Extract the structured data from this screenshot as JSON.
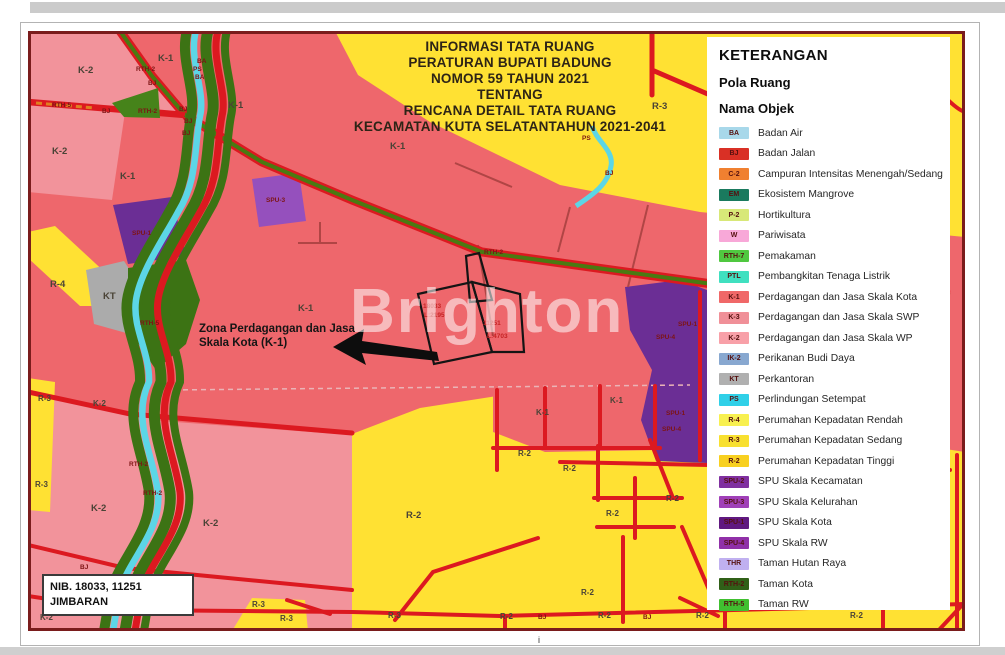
{
  "watermark": "Brighton",
  "title": {
    "lines": [
      "INFORMASI TATA RUANG",
      "PERATURAN BUPATI BADUNG",
      "NOMOR 59 TAHUN 2021",
      "TENTANG",
      "RENCANA DETAIL TATA RUANG",
      "KECAMATAN KUTA SELATANTAHUN 2021-2041"
    ]
  },
  "annotation": {
    "line1": "Zona Perdagangan dan Jasa",
    "line2": "Skala Kota (K-1)"
  },
  "nib_box": {
    "line1": "NIB. 18033, 11251",
    "line2": "JIMBARAN"
  },
  "tick": "i",
  "legend": {
    "title": "KETERANGAN",
    "subtitle1": "Pola Ruang",
    "subtitle2": "Nama Objek",
    "items": [
      {
        "code": "BA",
        "color": "#a8d8ea",
        "label": "Badan Air"
      },
      {
        "code": "BJ",
        "color": "#d93025",
        "label": "Badan Jalan"
      },
      {
        "code": "C-2",
        "color": "#f08030",
        "label": "Campuran Intensitas Menengah/Sedang"
      },
      {
        "code": "EM",
        "color": "#1a7a5e",
        "label": "Ekosistem Mangrove"
      },
      {
        "code": "P-2",
        "color": "#d8e878",
        "label": "Hortikultura"
      },
      {
        "code": "W",
        "color": "#f8a8d8",
        "label": "Pariwisata"
      },
      {
        "code": "RTH-7",
        "color": "#50c840",
        "label": "Pemakaman"
      },
      {
        "code": "PTL",
        "color": "#40e0c0",
        "label": "Pembangkitan Tenaga Listrik"
      },
      {
        "code": "K-1",
        "color": "#f06868",
        "label": "Perdagangan dan Jasa Skala Kota"
      },
      {
        "code": "K-3",
        "color": "#f09098",
        "label": "Perdagangan dan Jasa Skala SWP"
      },
      {
        "code": "K-2",
        "color": "#f8a0a8",
        "label": "Perdagangan dan Jasa Skala WP"
      },
      {
        "code": "IK-2",
        "color": "#88a8d0",
        "label": "Perikanan Budi Daya"
      },
      {
        "code": "KT",
        "color": "#b0b0b0",
        "label": "Perkantoran"
      },
      {
        "code": "PS",
        "color": "#30d0e8",
        "label": "Perlindungan Setempat"
      },
      {
        "code": "R-4",
        "color": "#f8f050",
        "label": "Perumahan Kepadatan Rendah"
      },
      {
        "code": "R-3",
        "color": "#f8e030",
        "label": "Perumahan Kepadatan Sedang"
      },
      {
        "code": "R-2",
        "color": "#f8d020",
        "label": "Perumahan Kepadatan Tinggi"
      },
      {
        "code": "SPU-2",
        "color": "#8030a0",
        "label": "SPU Skala Kecamatan"
      },
      {
        "code": "SPU-3",
        "color": "#a040b8",
        "label": "SPU Skala Kelurahan"
      },
      {
        "code": "SPU-1",
        "color": "#601880",
        "label": "SPU Skala Kota"
      },
      {
        "code": "SPU-4",
        "color": "#9030a8",
        "label": "SPU Skala RW"
      },
      {
        "code": "THR",
        "color": "#c0b0f0",
        "label": "Taman Hutan Raya"
      },
      {
        "code": "RTH-2",
        "color": "#306018",
        "label": "Taman Kota"
      },
      {
        "code": "RTH-5",
        "color": "#40c030",
        "label": "Taman RW"
      }
    ]
  },
  "colors": {
    "k1_commercial": "#ee676c",
    "k2_commercial": "#f2939b",
    "residential_yellow": "#ffe133",
    "road_red": "#dc1920",
    "river_cyan": "#5cd6e6",
    "green_rth": "#3c7314",
    "purple_spu": "#6b2e95",
    "gray_kt": "#ababab"
  },
  "map": {
    "labels": [
      {
        "t": "K-2",
        "x": 78,
        "y": 73,
        "k": "z"
      },
      {
        "t": "K-1",
        "x": 158,
        "y": 61,
        "k": "z"
      },
      {
        "t": "K-1",
        "x": 228,
        "y": 108,
        "k": "z"
      },
      {
        "t": "K-1",
        "x": 390,
        "y": 149,
        "k": "z"
      },
      {
        "t": "R-3",
        "x": 652,
        "y": 109,
        "k": "z"
      },
      {
        "t": "K-2",
        "x": 52,
        "y": 154,
        "k": "z"
      },
      {
        "t": "K-1",
        "x": 120,
        "y": 179,
        "k": "z"
      },
      {
        "t": "K-1",
        "x": 298,
        "y": 311,
        "k": "z"
      },
      {
        "t": "R-4",
        "x": 50,
        "y": 287,
        "k": "z"
      },
      {
        "t": "KT",
        "x": 103,
        "y": 299,
        "k": "z"
      },
      {
        "t": "K-1",
        "x": 536,
        "y": 415,
        "k": "zs"
      },
      {
        "t": "K-1",
        "x": 610,
        "y": 403,
        "k": "zs"
      },
      {
        "t": "K-2",
        "x": 93,
        "y": 406,
        "k": "zs"
      },
      {
        "t": "K-2",
        "x": 91,
        "y": 511,
        "k": "z"
      },
      {
        "t": "K-2",
        "x": 203,
        "y": 526,
        "k": "z"
      },
      {
        "t": "R-3",
        "x": 38,
        "y": 401,
        "k": "zs"
      },
      {
        "t": "R-3",
        "x": 35,
        "y": 487,
        "k": "zs"
      },
      {
        "t": "R-2",
        "x": 406,
        "y": 518,
        "k": "z"
      },
      {
        "t": "R-2",
        "x": 518,
        "y": 456,
        "k": "zs"
      },
      {
        "t": "R-2",
        "x": 563,
        "y": 471,
        "k": "zs"
      },
      {
        "t": "R-2",
        "x": 606,
        "y": 516,
        "k": "zs"
      },
      {
        "t": "R-2",
        "x": 666,
        "y": 501,
        "k": "zs"
      },
      {
        "t": "R-2",
        "x": 581,
        "y": 595,
        "k": "zs"
      },
      {
        "t": "K-2",
        "x": 40,
        "y": 620,
        "k": "zs"
      },
      {
        "t": "K-2",
        "x": 170,
        "y": 615,
        "k": "zs"
      },
      {
        "t": "R-3",
        "x": 252,
        "y": 607,
        "k": "zs"
      },
      {
        "t": "R-3",
        "x": 280,
        "y": 621,
        "k": "zs"
      },
      {
        "t": "R-3",
        "x": 388,
        "y": 618,
        "k": "zs"
      },
      {
        "t": "R-2",
        "x": 500,
        "y": 619,
        "k": "zs"
      },
      {
        "t": "R-2",
        "x": 598,
        "y": 618,
        "k": "zs"
      },
      {
        "t": "R-2",
        "x": 696,
        "y": 618,
        "k": "zs"
      },
      {
        "t": "R-2",
        "x": 850,
        "y": 618,
        "k": "zs"
      },
      {
        "t": "BA",
        "x": 197,
        "y": 63,
        "k": "r"
      },
      {
        "t": "PS",
        "x": 193,
        "y": 71,
        "k": "r"
      },
      {
        "t": "BA",
        "x": 195,
        "y": 79,
        "k": "r"
      },
      {
        "t": "RTH-2",
        "x": 136,
        "y": 71,
        "k": "r"
      },
      {
        "t": "BJ",
        "x": 148,
        "y": 85,
        "k": "r"
      },
      {
        "t": "RTH-5",
        "x": 52,
        "y": 107,
        "k": "r"
      },
      {
        "t": "BJ",
        "x": 102,
        "y": 113,
        "k": "r"
      },
      {
        "t": "RTH-2",
        "x": 138,
        "y": 113,
        "k": "r"
      },
      {
        "t": "BJ",
        "x": 179,
        "y": 111,
        "k": "r"
      },
      {
        "t": "BJ",
        "x": 184,
        "y": 123,
        "k": "r"
      },
      {
        "t": "BJ",
        "x": 182,
        "y": 135,
        "k": "r"
      },
      {
        "t": "SPU-3",
        "x": 266,
        "y": 202,
        "k": "r"
      },
      {
        "t": "SPU-1",
        "x": 132,
        "y": 235,
        "k": "r"
      },
      {
        "t": "RTH-2",
        "x": 484,
        "y": 254,
        "k": "r"
      },
      {
        "t": "RTH-5",
        "x": 140,
        "y": 325,
        "k": "r"
      },
      {
        "t": "PS",
        "x": 582,
        "y": 140,
        "k": "r"
      },
      {
        "t": "BJ",
        "x": 605,
        "y": 175,
        "k": "r"
      },
      {
        "t": "SPU-1",
        "x": 678,
        "y": 326,
        "k": "r"
      },
      {
        "t": "SPU-4",
        "x": 656,
        "y": 339,
        "k": "r"
      },
      {
        "t": "SPU-1",
        "x": 666,
        "y": 415,
        "k": "r"
      },
      {
        "t": "SPU-4",
        "x": 662,
        "y": 431,
        "k": "r"
      },
      {
        "t": "RTH-2",
        "x": 129,
        "y": 466,
        "k": "r"
      },
      {
        "t": "RTH-2",
        "x": 143,
        "y": 495,
        "k": "r"
      },
      {
        "t": "BJ",
        "x": 80,
        "y": 569,
        "k": "r"
      },
      {
        "t": "BJ",
        "x": 126,
        "y": 581,
        "k": "r"
      },
      {
        "t": "BJ",
        "x": 538,
        "y": 619,
        "k": "r"
      },
      {
        "t": "BJ",
        "x": 643,
        "y": 619,
        "k": "r"
      },
      {
        "t": "18033",
        "x": 423,
        "y": 308,
        "k": "r2"
      },
      {
        "t": "L:2195",
        "x": 424,
        "y": 317,
        "k": "r2"
      },
      {
        "t": "11251",
        "x": 483,
        "y": 325,
        "k": "r2"
      },
      {
        "t": "L:4703",
        "x": 487,
        "y": 338,
        "k": "r2"
      }
    ]
  }
}
